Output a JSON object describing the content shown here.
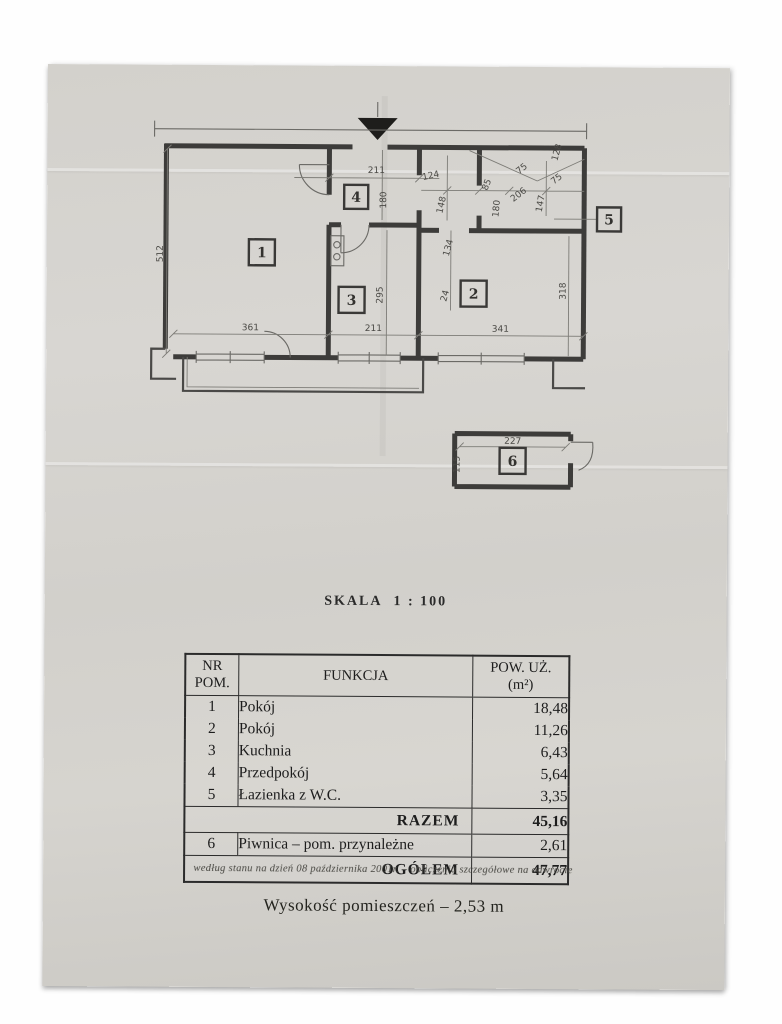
{
  "page": {
    "scale_label": "SKALA  1 : 100",
    "footnote": "według stanu na dzień 08 października 2001r. – obliczenia szczegółowe na odwrocie",
    "height_note": "Wysokość pomieszczeń – 2,53 m"
  },
  "plan": {
    "rooms": {
      "r1": "1",
      "r2": "2",
      "r3": "3",
      "r4": "4",
      "r5": "5",
      "r6": "6"
    },
    "dims": {
      "d512": "512",
      "d361": "361",
      "d211_bottom": "211",
      "d341": "341",
      "d211_top": "211",
      "d180_hall": "180",
      "d295": "295",
      "d318": "318",
      "d124": "124",
      "d148": "148",
      "d85": "85",
      "d180_right": "180",
      "d206": "206",
      "d75_a": "75",
      "d147": "147",
      "d75_b": "75",
      "d128": "128",
      "d134": "134",
      "d24": "24",
      "d227": "227",
      "d115": "115"
    }
  },
  "table": {
    "header": {
      "nr_line1": "NR",
      "nr_line2": "POM.",
      "funkcja": "FUNKCJA",
      "pow_line1": "POW. UŻ.",
      "pow_line2": "(m²)"
    },
    "rows": [
      {
        "nr": "1",
        "funkcja": "Pokój",
        "pow": "18,48"
      },
      {
        "nr": "2",
        "funkcja": "Pokój",
        "pow": "11,26"
      },
      {
        "nr": "3",
        "funkcja": "Kuchnia",
        "pow": "6,43"
      },
      {
        "nr": "4",
        "funkcja": "Przedpokój",
        "pow": "5,64"
      },
      {
        "nr": "5",
        "funkcja": "Łazienka z W.C.",
        "pow": "3,35"
      }
    ],
    "razem": {
      "label": "RAZEM",
      "value": "45,16"
    },
    "row6": {
      "nr": "6",
      "funkcja": "Piwnica – pom. przynależne",
      "pow": "2,61"
    },
    "ogolem": {
      "label": "OGÓŁEM",
      "value": "47,77"
    }
  }
}
